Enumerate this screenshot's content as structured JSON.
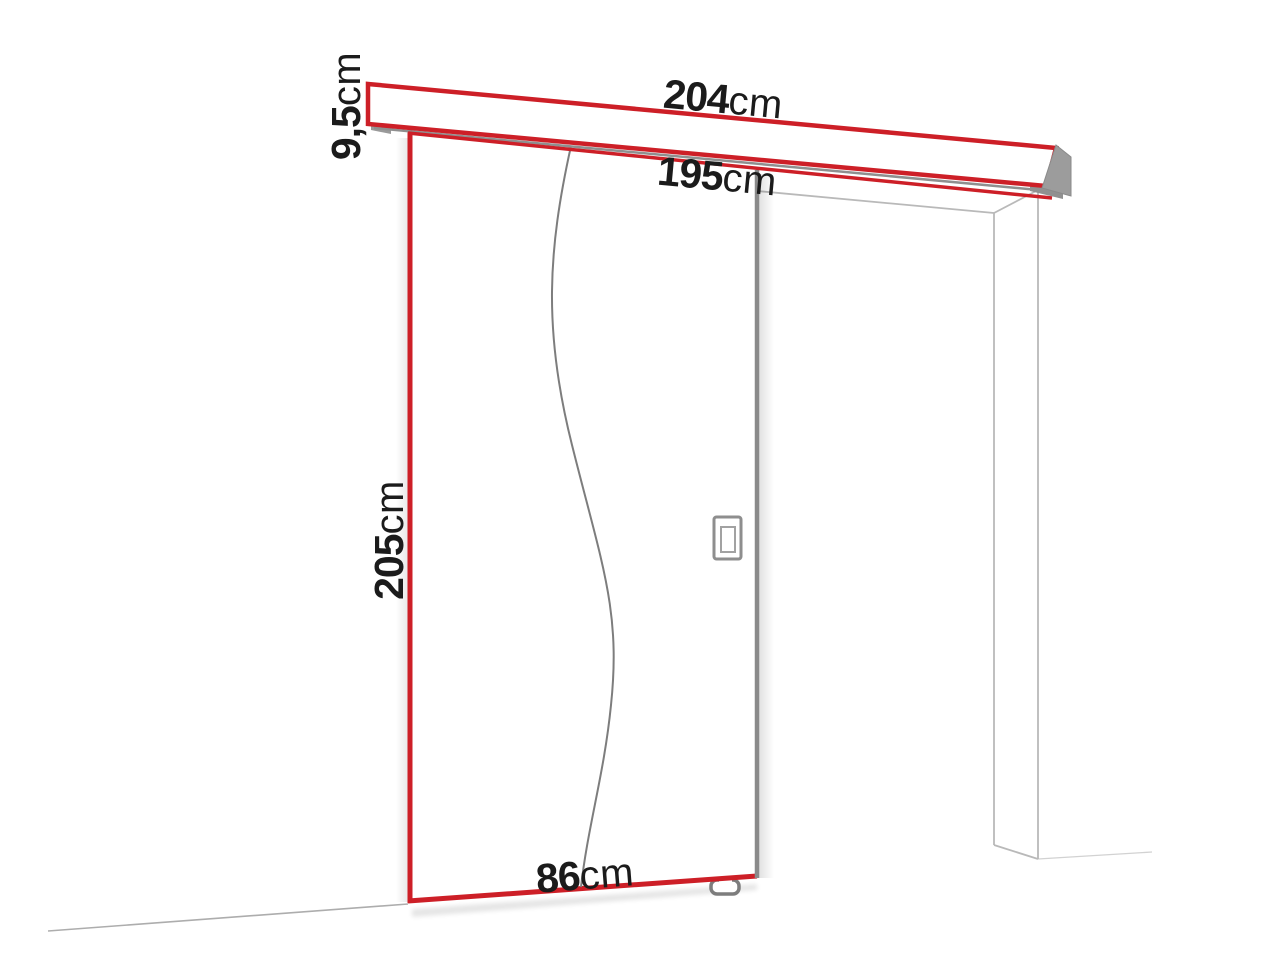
{
  "diagram": {
    "labels": {
      "track_width": {
        "value": "204",
        "unit": "cm"
      },
      "track_height": {
        "value": "9,5",
        "unit": "cm"
      },
      "rail_width": {
        "value": "195",
        "unit": "cm"
      },
      "door_height": {
        "value": "205",
        "unit": "cm"
      },
      "door_width": {
        "value": "86",
        "unit": "cm"
      }
    },
    "colors": {
      "accent_red": "#cd1f27",
      "door_edge_gray": "#8a8a8a",
      "rail_gray": "#8f8f8f",
      "frame_line_gray": "#b9b9b9",
      "floor_line_gray": "#adadad",
      "text_black": "#1b1b1b"
    }
  }
}
